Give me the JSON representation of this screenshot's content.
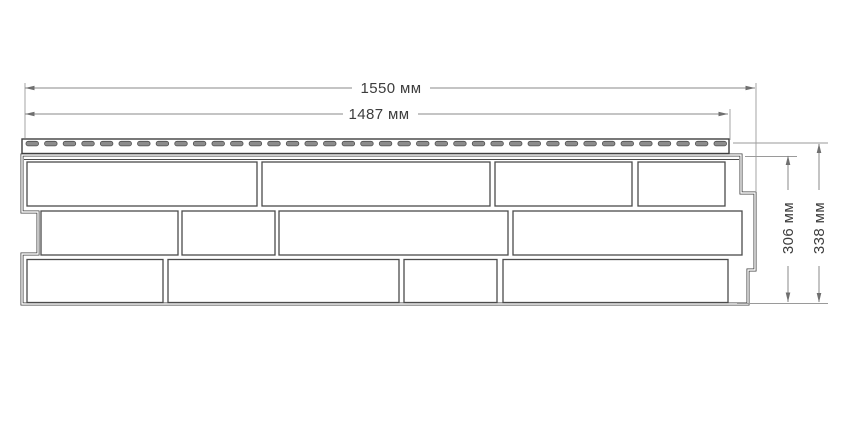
{
  "diagram": {
    "kind": "panel-dimension-drawing",
    "units": "мм",
    "dimensions": {
      "overall_width": {
        "value": 1550,
        "label": "1550 мм"
      },
      "face_width": {
        "value": 1487,
        "label": "1487 мм"
      },
      "face_height": {
        "value": 306,
        "label": "306 мм"
      },
      "overall_height": {
        "value": 338,
        "label": "338 мм"
      }
    },
    "panel": {
      "nail_strip": {
        "slot_count": 38
      },
      "brick_rows": [
        {
          "y": 162,
          "height": 44,
          "bricks": [
            [
              27,
              230
            ],
            [
              262,
              228
            ],
            [
              495,
              137
            ],
            [
              638,
              87
            ]
          ]
        },
        {
          "y": 211,
          "height": 44,
          "bricks": [
            [
              41,
              137
            ],
            [
              182,
              93
            ],
            [
              279,
              229
            ],
            [
              513,
              229
            ]
          ]
        },
        {
          "y": 259.5,
          "height": 43,
          "bricks": [
            [
              27,
              136
            ],
            [
              168,
              231
            ],
            [
              404,
              93
            ],
            [
              503,
              225
            ]
          ]
        }
      ]
    },
    "colors": {
      "background": "#ffffff",
      "panel_outline": "#3f3f3f",
      "brick_outline": "#4b4b4b",
      "dimension_line": "#8a8a8a",
      "text": "#3d3d3d",
      "slot_fill": "#8c8c8c"
    }
  }
}
